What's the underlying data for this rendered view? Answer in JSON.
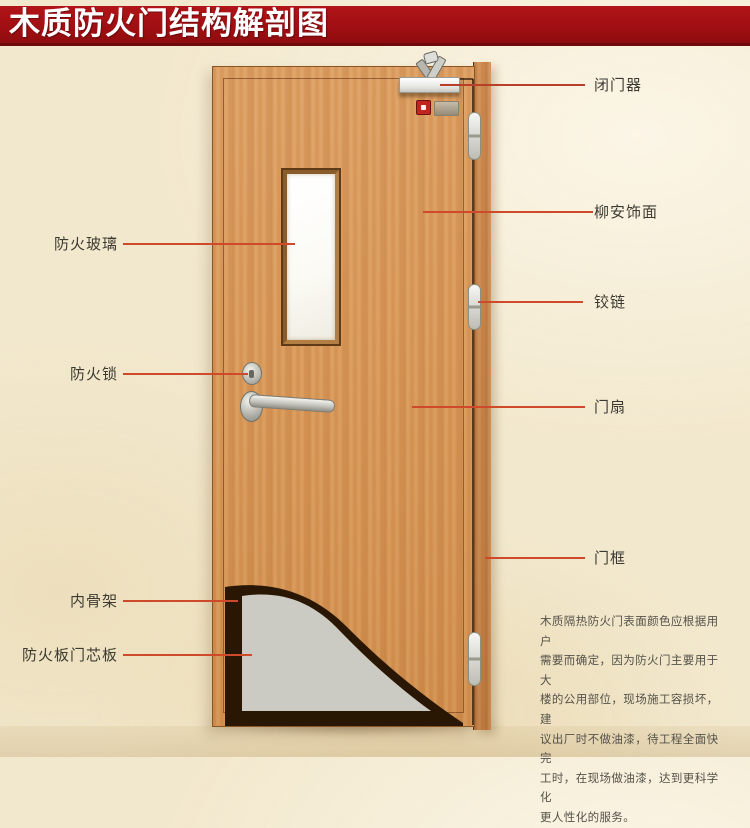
{
  "title": "木质防火门结构解剖图",
  "labels": {
    "left": [
      {
        "id": "fire-glass",
        "text": "防火玻璃"
      },
      {
        "id": "fire-lock",
        "text": "防火锁"
      },
      {
        "id": "inner-skeleton",
        "text": "内骨架"
      },
      {
        "id": "fire-board-core",
        "text": "防火板门芯板"
      }
    ],
    "right": [
      {
        "id": "door-closer",
        "text": "闭门器"
      },
      {
        "id": "lauan-veneer",
        "text": "柳安饰面"
      },
      {
        "id": "hinge",
        "text": "铰链"
      },
      {
        "id": "door-leaf",
        "text": "门扇"
      },
      {
        "id": "door-frame",
        "text": "门框"
      }
    ]
  },
  "description": "木质隔热防火门表面颜色应根据用户\n需要而确定，因为防火门主要用于大\n楼的公用部位，现场施工容损坏，建\n议出厂时不做油漆，待工程全面快完\n工时，在现场做油漆，达到更科学化\n更人性化的服务。",
  "colors": {
    "banner_red": "#a31013",
    "leader_line": "#cf4a2a",
    "door_wood": "#d69455",
    "frame_wood": "#c8854a",
    "core_gray": "#cbcbc3",
    "skeleton_brown": "#2a1703",
    "background_parchment": "#f2e8cd",
    "label_text": "#3c3a31"
  }
}
